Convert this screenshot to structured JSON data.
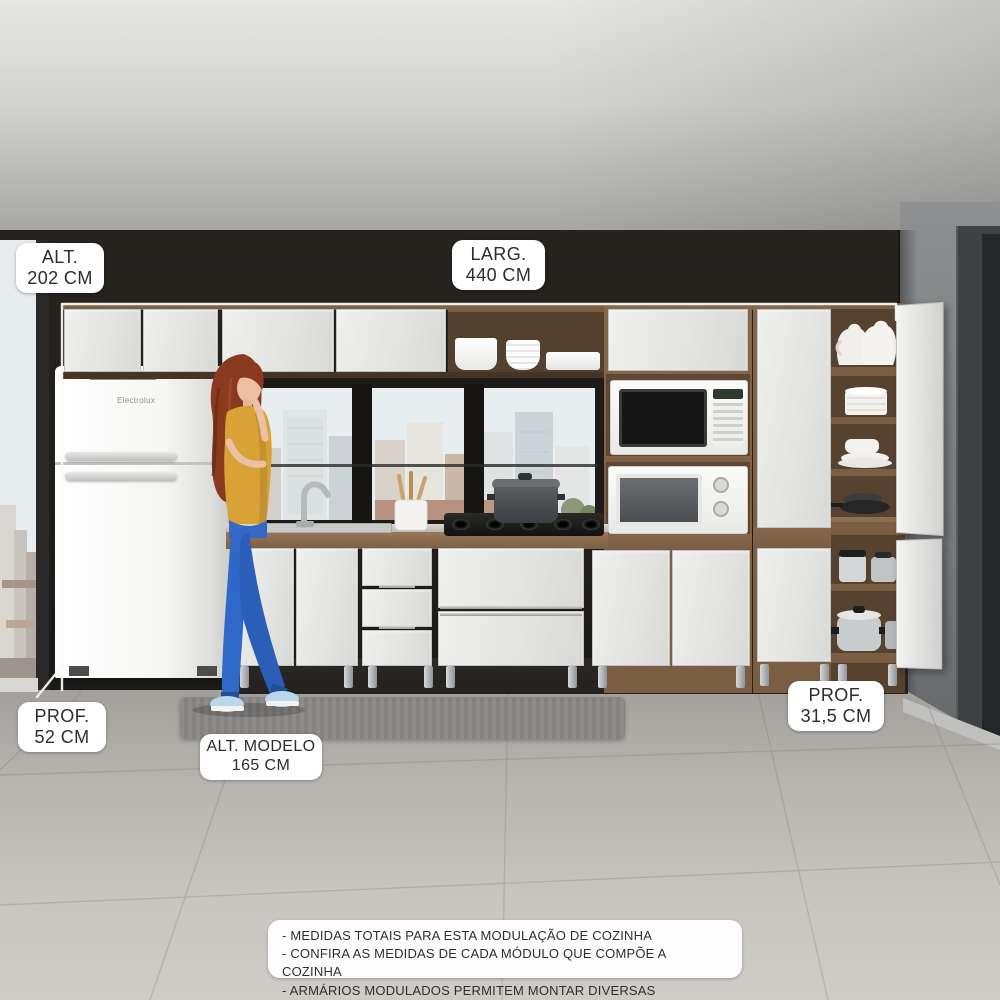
{
  "labels": {
    "alt_total": {
      "line1": "ALT.",
      "line2": "202 CM"
    },
    "larg_total": {
      "line1": "LARG.",
      "line2": "440 CM"
    },
    "prof_fridge": {
      "line1": "PROF.",
      "line2": "52 CM"
    },
    "alt_modelo": {
      "line1": "ALT. MODELO",
      "line2": "165 CM"
    },
    "prof_cabinet": {
      "line1": "PROF.",
      "line2": "31,5 CM"
    }
  },
  "notes": [
    "- MEDIDAS TOTAIS PARA ESTA MODULAÇÃO DE COZINHA",
    "- CONFIRA AS MEDIDAS DE CADA MÓDULO QUE COMPÕE A COZINHA",
    "- ARMÁRIOS MODULADOS PERMITEM MONTAR DIVERSAS COMPOSIÇÕES"
  ],
  "fridge": {
    "brand": "Electrolux"
  },
  "colors": {
    "wall_dark": "#221f1d",
    "wood": "#7d6148",
    "cabinet_white": "#eaeae8",
    "label_bg": "#ffffff",
    "label_text": "#2d2d2d",
    "jeans_blue": "#2f68c8",
    "shirt_mustard": "#d8a236"
  }
}
